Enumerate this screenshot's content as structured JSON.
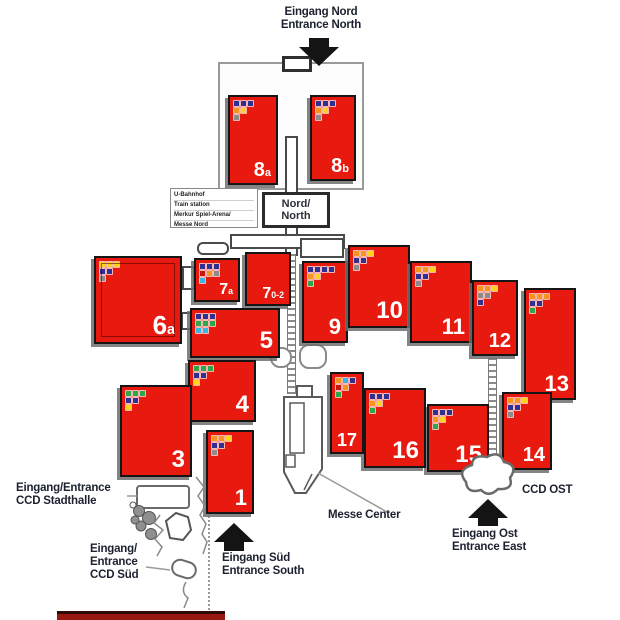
{
  "title": "Fairground hall map",
  "labels": {
    "entrance_north": {
      "line1": "Eingang Nord",
      "line2": "Entrance North"
    },
    "entrance_south": {
      "line1": "Eingang Süd",
      "line2": "Entrance South"
    },
    "entrance_east": {
      "line1": "Eingang Ost",
      "line2": "Entrance East"
    },
    "ccd_stadthalle": {
      "line1": "Eingang/Entrance",
      "line2": "CCD Stadthalle"
    },
    "ccd_sued": {
      "line1": "Eingang/",
      "line2": "Entrance",
      "line3": "CCD Süd"
    },
    "ccd_ost": "CCD OST",
    "messe_center": "Messe Center",
    "nord_box": {
      "line1": "Nord/",
      "line2": "North"
    },
    "station_box": [
      "U-Bahnhof",
      "Train station",
      "Merkur Spiel-Arena/",
      "Messe Nord"
    ]
  },
  "palette": {
    "hall_red": "#e8190f",
    "hall_border": "#151515",
    "map_text": "#1c2130",
    "icon_navy": "#2e3192",
    "icon_orange": "#f7941d",
    "icon_yellow": "#ffd21e",
    "icon_gray": "#8c8c8c",
    "icon_green": "#2ba84a",
    "icon_cyan": "#35b7e5",
    "icon_red": "#c9150b"
  },
  "halls": [
    {
      "id": "8a",
      "label": "8",
      "sub": "a",
      "fs": 20,
      "x": 228,
      "y": 95,
      "w": 50,
      "h": 90,
      "icons": [
        [
          "#2e3192",
          "#2e3192",
          "#2e3192"
        ],
        [
          "#f7941d",
          "#ffd21e"
        ],
        [
          "#8c8c8c"
        ]
      ]
    },
    {
      "id": "8b",
      "label": "8",
      "sub": "b",
      "fs": 20,
      "x": 310,
      "y": 95,
      "w": 46,
      "h": 86,
      "icons": [
        [
          "#2e3192",
          "#2e3192",
          "#2e3192"
        ],
        [
          "#f7941d",
          "#ffd21e"
        ],
        [
          "#8c8c8c"
        ]
      ]
    },
    {
      "id": "6",
      "label": "6",
      "sub": "a",
      "fs": 26,
      "x": 94,
      "y": 256,
      "w": 88,
      "h": 88,
      "inner": true,
      "icons": [
        [
          "#ffd21e",
          "#ffd21e",
          "#ffd21e"
        ],
        [
          "#2e3192",
          "#2e3192"
        ],
        [
          "#8c8c8c"
        ]
      ]
    },
    {
      "id": "7a",
      "label": "7",
      "sub": "a",
      "fs": 16,
      "x": 194,
      "y": 258,
      "w": 46,
      "h": 44,
      "icons": [
        [
          "#2e3192",
          "#2e3192",
          "#2e3192"
        ],
        [
          "#c9150b",
          "#f7941d",
          "#8c8c8c"
        ],
        [
          "#35b7e5"
        ]
      ]
    },
    {
      "id": "7.0-2",
      "label": "7",
      "sub": "0-2",
      "fs": 16,
      "x": 245,
      "y": 252,
      "w": 46,
      "h": 54,
      "icons": []
    },
    {
      "id": "5",
      "label": "5",
      "fs": 24,
      "x": 190,
      "y": 308,
      "w": 90,
      "h": 50,
      "icons": [
        [
          "#2e3192",
          "#2e3192",
          "#2e3192"
        ],
        [
          "#2ba84a",
          "#2ba84a",
          "#2ba84a"
        ],
        [
          "#35b7e5",
          "#35b7e5"
        ]
      ]
    },
    {
      "id": "4",
      "label": "4",
      "fs": 24,
      "x": 188,
      "y": 360,
      "w": 68,
      "h": 62,
      "icons": [
        [
          "#2ba84a",
          "#2ba84a",
          "#2ba84a"
        ],
        [
          "#2e3192",
          "#2e3192"
        ],
        [
          "#ffd21e"
        ]
      ]
    },
    {
      "id": "3",
      "label": "3",
      "fs": 24,
      "x": 120,
      "y": 385,
      "w": 72,
      "h": 92,
      "icons": [
        [
          "#2ba84a",
          "#2ba84a",
          "#2ba84a"
        ],
        [
          "#2e3192",
          "#2e3192"
        ],
        [
          "#ffd21e"
        ]
      ]
    },
    {
      "id": "1",
      "label": "1",
      "fs": 22,
      "x": 206,
      "y": 430,
      "w": 48,
      "h": 84,
      "icons": [
        [
          "#f7941d",
          "#f7941d",
          "#ffd21e"
        ],
        [
          "#2e3192",
          "#2e3192"
        ],
        [
          "#8c8c8c"
        ]
      ]
    },
    {
      "id": "9",
      "label": "9",
      "fs": 22,
      "x": 302,
      "y": 261,
      "w": 46,
      "h": 82,
      "icons": [
        [
          "#2e3192",
          "#2e3192",
          "#2e3192",
          "#2e3192"
        ],
        [
          "#f7941d",
          "#ffd21e"
        ],
        [
          "#2ba84a"
        ]
      ]
    },
    {
      "id": "10",
      "label": "10",
      "fs": 24,
      "x": 348,
      "y": 245,
      "w": 62,
      "h": 83,
      "icons": [
        [
          "#f7941d",
          "#f7941d",
          "#ffd21e"
        ],
        [
          "#2e3192",
          "#2e3192"
        ],
        [
          "#8c8c8c"
        ]
      ]
    },
    {
      "id": "11",
      "label": "11",
      "fs": 22,
      "x": 410,
      "y": 261,
      "w": 62,
      "h": 82,
      "icons": [
        [
          "#f7941d",
          "#f7941d",
          "#ffd21e"
        ],
        [
          "#2e3192",
          "#2e3192"
        ],
        [
          "#8c8c8c"
        ]
      ]
    },
    {
      "id": "12",
      "label": "12",
      "fs": 20,
      "x": 472,
      "y": 280,
      "w": 46,
      "h": 76,
      "icons": [
        [
          "#f7941d",
          "#f7941d",
          "#ffd21e"
        ],
        [
          "#8c8c8c",
          "#8c8c8c"
        ],
        [
          "#2e3192"
        ]
      ]
    },
    {
      "id": "13",
      "label": "13",
      "fs": 22,
      "x": 524,
      "y": 288,
      "w": 52,
      "h": 112,
      "icons": [
        [
          "#f7941d",
          "#f7941d",
          "#f7941d"
        ],
        [
          "#2e3192",
          "#2e3192"
        ],
        [
          "#2ba84a"
        ]
      ]
    },
    {
      "id": "14",
      "label": "14",
      "fs": 20,
      "x": 502,
      "y": 392,
      "w": 50,
      "h": 78,
      "icons": [
        [
          "#f7941d",
          "#f7941d",
          "#ffd21e"
        ],
        [
          "#2e3192",
          "#2e3192"
        ],
        [
          "#8c8c8c"
        ]
      ]
    },
    {
      "id": "15",
      "label": "15",
      "fs": 24,
      "x": 427,
      "y": 404,
      "w": 62,
      "h": 68,
      "icons": [
        [
          "#2e3192",
          "#2e3192",
          "#2e3192"
        ],
        [
          "#f7941d",
          "#ffd21e"
        ],
        [
          "#2ba84a"
        ]
      ]
    },
    {
      "id": "16",
      "label": "16",
      "fs": 24,
      "x": 364,
      "y": 388,
      "w": 62,
      "h": 80,
      "icons": [
        [
          "#2e3192",
          "#2e3192",
          "#2e3192"
        ],
        [
          "#f7941d",
          "#ffd21e"
        ],
        [
          "#2ba84a"
        ]
      ]
    },
    {
      "id": "17",
      "label": "17",
      "fs": 18,
      "x": 330,
      "y": 372,
      "w": 34,
      "h": 82,
      "icons": [
        [
          "#f7941d",
          "#35b7e5",
          "#2e3192"
        ],
        [
          "#c9150b",
          "#f7941d"
        ],
        [
          "#2ba84a"
        ]
      ]
    }
  ]
}
